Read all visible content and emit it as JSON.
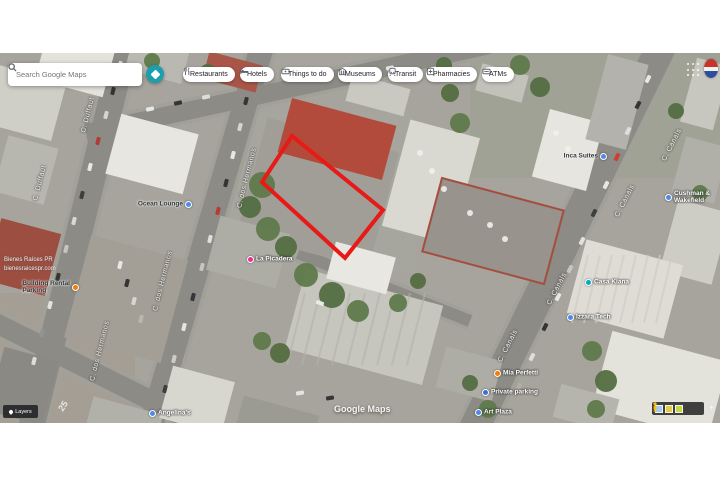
{
  "app": {
    "search_placeholder": "Search Google Maps"
  },
  "chips": [
    {
      "label": "Restaurants",
      "icon": "restaurant-icon",
      "x": 183
    },
    {
      "label": "Hotels",
      "icon": "hotel-icon",
      "x": 240
    },
    {
      "label": "Things to do",
      "icon": "ticket-icon",
      "x": 281
    },
    {
      "label": "Museums",
      "icon": "museum-icon",
      "x": 338
    },
    {
      "label": "Transit",
      "icon": "transit-icon",
      "x": 388
    },
    {
      "label": "Pharmacies",
      "icon": "pharmacy-icon",
      "x": 426
    },
    {
      "label": "ATMs",
      "icon": "atm-icon",
      "x": 482
    }
  ],
  "street_labels": [
    {
      "text": "C. Duffaut",
      "x": 88,
      "y": 62,
      "rot": -76
    },
    {
      "text": "C. Duffaut",
      "x": 40,
      "y": 130,
      "rot": -76
    },
    {
      "text": "C. dos Hermanos",
      "x": 247,
      "y": 125,
      "rot": -76
    },
    {
      "text": "C. dos Hermanos",
      "x": 163,
      "y": 228,
      "rot": -76
    },
    {
      "text": "C. dos Hermanos",
      "x": 100,
      "y": 298,
      "rot": -76
    },
    {
      "text": "C. Canals",
      "x": 672,
      "y": 92,
      "rot": -63
    },
    {
      "text": "C. Canals",
      "x": 625,
      "y": 148,
      "rot": -63
    },
    {
      "text": "C. Canals",
      "x": 557,
      "y": 236,
      "rot": -63
    },
    {
      "text": "C. Canals",
      "x": 508,
      "y": 293,
      "rot": -63
    }
  ],
  "pois": [
    {
      "name": "Ocean Lounge",
      "icon": "blue",
      "icon_x": 188,
      "icon_y": 151,
      "style": "dark",
      "icon_after": true
    },
    {
      "name": "La Picadera",
      "icon": "pink",
      "icon_x": 250,
      "icon_y": 206,
      "style": "light",
      "icon_after": false
    },
    {
      "name": "Inca Suites",
      "icon": "blue",
      "icon_x": 603,
      "icon_y": 103,
      "style": "dark",
      "icon_after": true
    },
    {
      "name": "Cushman &",
      "name2": "Wakefield",
      "icon": "blue",
      "icon_x": 668,
      "icon_y": 144,
      "style": "light",
      "icon_after": false
    },
    {
      "name": "Casa Kiana",
      "icon": "teal",
      "icon_x": 588,
      "icon_y": 229,
      "style": "light",
      "icon_after": false
    },
    {
      "name": "Izzara Tech",
      "icon": "blue",
      "icon_x": 570,
      "icon_y": 264,
      "style": "light",
      "icon_after": false
    },
    {
      "name": "Mia Perfetti",
      "icon": "orange",
      "icon_x": 497,
      "icon_y": 320,
      "style": "light",
      "icon_after": false
    },
    {
      "name": "Private parking",
      "icon": "parking",
      "icon_x": 485,
      "icon_y": 339,
      "style": "light",
      "icon_after": false
    },
    {
      "name": "Art Plaza",
      "icon": "blue",
      "icon_x": 478,
      "icon_y": 359,
      "style": "light",
      "icon_after": false
    },
    {
      "name": "Angelina's",
      "icon": "blue",
      "icon_x": 152,
      "icon_y": 360,
      "style": "light",
      "icon_after": false
    },
    {
      "name": "Building Rental",
      "name2": "Parking",
      "icon": "orange",
      "icon_x": 75,
      "icon_y": 234,
      "style": "dark",
      "icon_after": true
    }
  ],
  "map_texts": {
    "google_watermark": "Google Maps",
    "layers_label": "Layers",
    "road_paint": "25",
    "watermark_line1": "Bienes Raíces PR",
    "watermark_line2": "bienesraicespr.com"
  },
  "colors": {
    "boundary": "#e81a17",
    "directions_button": "#1b9fae",
    "poi_blue": "#4e88e8",
    "poi_pink": "#e9308f",
    "poi_orange": "#f57c00",
    "poi_teal": "#00acc1",
    "poi_parking": "#3a6fd8"
  }
}
